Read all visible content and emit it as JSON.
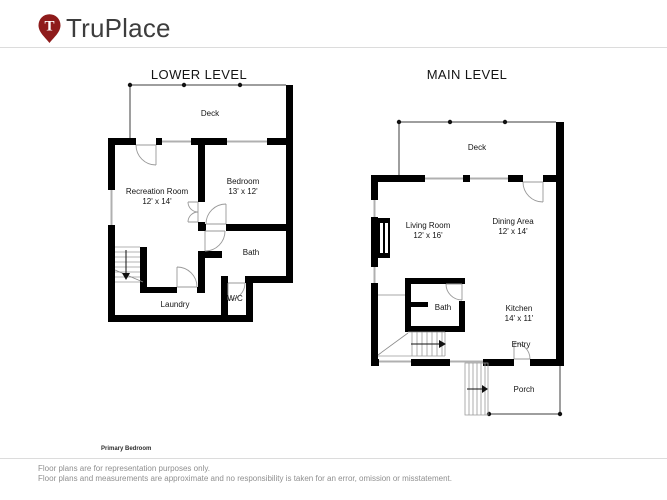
{
  "brand": {
    "name": "TruPlace",
    "pin_letter": "T",
    "pin_color": "#8e1b1b"
  },
  "levels": {
    "lower": {
      "title": "LOWER LEVEL",
      "rooms": {
        "deck": {
          "name": "Deck"
        },
        "recreation": {
          "name": "Recreation Room",
          "dims": "12' x 14'"
        },
        "bedroom": {
          "name": "Bedroom",
          "dims": "13' x 12'"
        },
        "bath": {
          "name": "Bath"
        },
        "laundry": {
          "name": "Laundry"
        },
        "wc": {
          "name": "W/C"
        }
      }
    },
    "main": {
      "title": "MAIN LEVEL",
      "rooms": {
        "deck": {
          "name": "Deck"
        },
        "living": {
          "name": "Living Room",
          "dims": "12' x 16'"
        },
        "dining": {
          "name": "Dining Area",
          "dims": "12' x 14'"
        },
        "kitchen": {
          "name": "Kitchen",
          "dims": "14' x 11'"
        },
        "bath": {
          "name": "Bath"
        },
        "entry": {
          "name": "Entry"
        },
        "porch": {
          "name": "Porch"
        }
      }
    }
  },
  "footnote": "Primary Bedroom",
  "disclaimer": {
    "line1": "Floor plans are for representation purposes only.",
    "line2": "Floor plans and measurements are approximate and no responsibility is taken for an error, omission or misstatement."
  },
  "colors": {
    "wall": "#000000",
    "window": "#b0b0b0",
    "door": "#999999"
  }
}
